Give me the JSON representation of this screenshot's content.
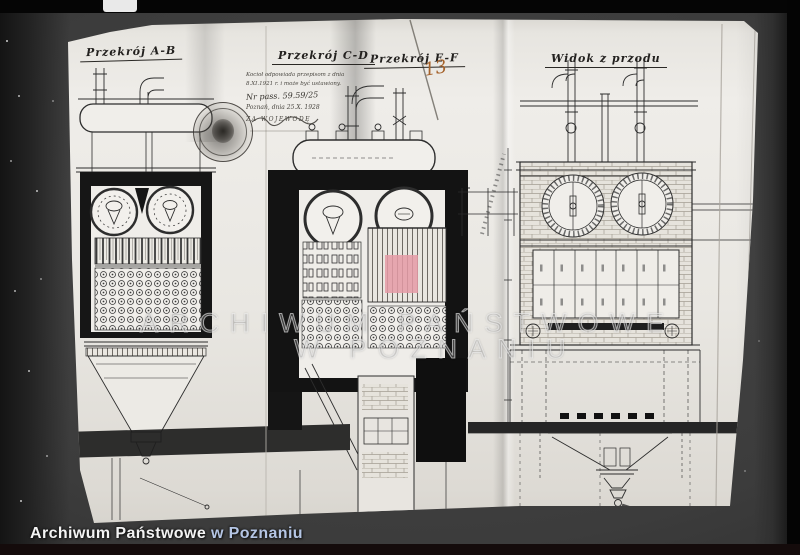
{
  "photo": {
    "caption": {
      "part1": "Archiwum Państwowe",
      "part2": "w Poznaniu"
    },
    "watermark": {
      "line1": "ARCHIWUM PAŃSTWOWE",
      "line2": "W POZNANIU"
    },
    "page_number": "13"
  },
  "drawing": {
    "section_labels": [
      {
        "id": "A-B",
        "text": "Przekrój A-B"
      },
      {
        "id": "C-D",
        "text": "Przekrój C-D"
      },
      {
        "id": "E-F",
        "text": "Przekrój E-F"
      },
      {
        "id": "front",
        "text": "Widok z przodu"
      }
    ],
    "stamp_note": {
      "line1": "Kocioł odpowiada przepisom z dnia",
      "line2": "8.XI.1921 r. i może być ustawiony.",
      "line3": "Nr pass. 59.59/25",
      "line4": "Poznań, dnia 25.X. 1928",
      "line5": "ZA WOJEWODĘ"
    },
    "colors": {
      "highlight_pink": "#e59aa6",
      "ink": "#2d2d2d",
      "paper": "#e9e7e2",
      "page_number_orange": "#a5622b",
      "caption_blue": "#b4c5e4"
    }
  }
}
